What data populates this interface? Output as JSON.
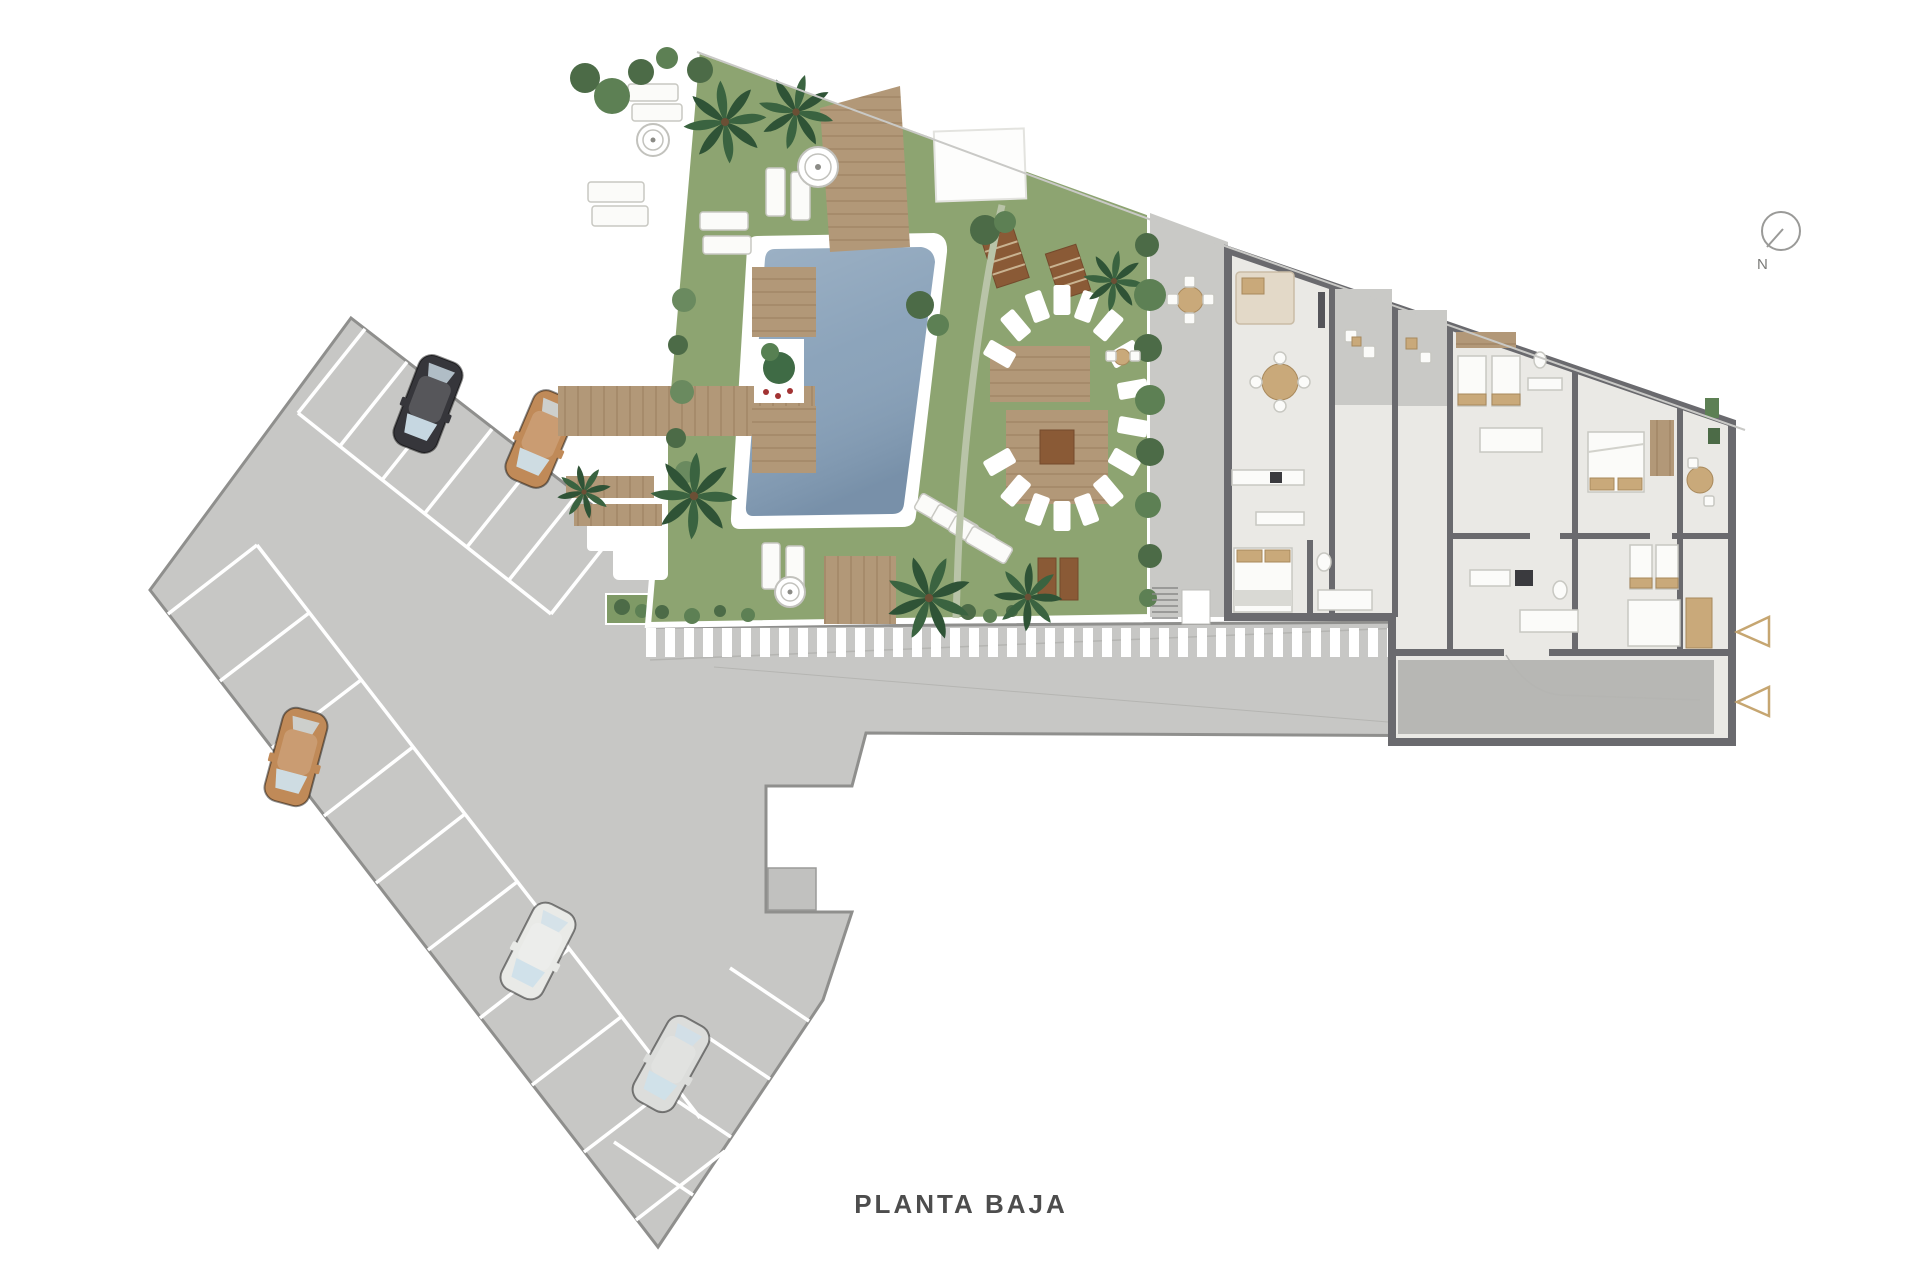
{
  "labels": {
    "floor_title": "PLANTA BAJA",
    "compass_north": "N"
  },
  "colors": {
    "background": "#ffffff",
    "pavement": "#c7c7c5",
    "pavement_border": "#8f8f8d",
    "stall_line": "#ffffff",
    "lawn": "#8da471",
    "pool_water": "#87a0b8",
    "pool_deck": "#ffffff",
    "wood_deck": "#b29878",
    "walkway_stripe": "#ffffff",
    "terrace_paving": "#c9c9c6",
    "building_floor": "#eae9e5",
    "building_wall": "#6a6a6e",
    "garage_floor": "#b7b7b4",
    "access_arrow": "#c6a671",
    "compass": "#9a9a98",
    "title_text": "#4d4d4d"
  },
  "cars": [
    {
      "name": "black-hatchback",
      "color": "#36363b"
    },
    {
      "name": "tan-suv",
      "color": "#c08a58"
    },
    {
      "name": "tan-suv-2",
      "color": "#c08a58"
    },
    {
      "name": "white-sedan",
      "color": "#e9eae7"
    },
    {
      "name": "silver-sedan",
      "color": "#dcdddb"
    }
  ],
  "plan": {
    "drawing_type": "site-plan",
    "floor_shown": "PLANTA BAJA",
    "access_arrows_visible": 2,
    "cars_visible": 5
  }
}
